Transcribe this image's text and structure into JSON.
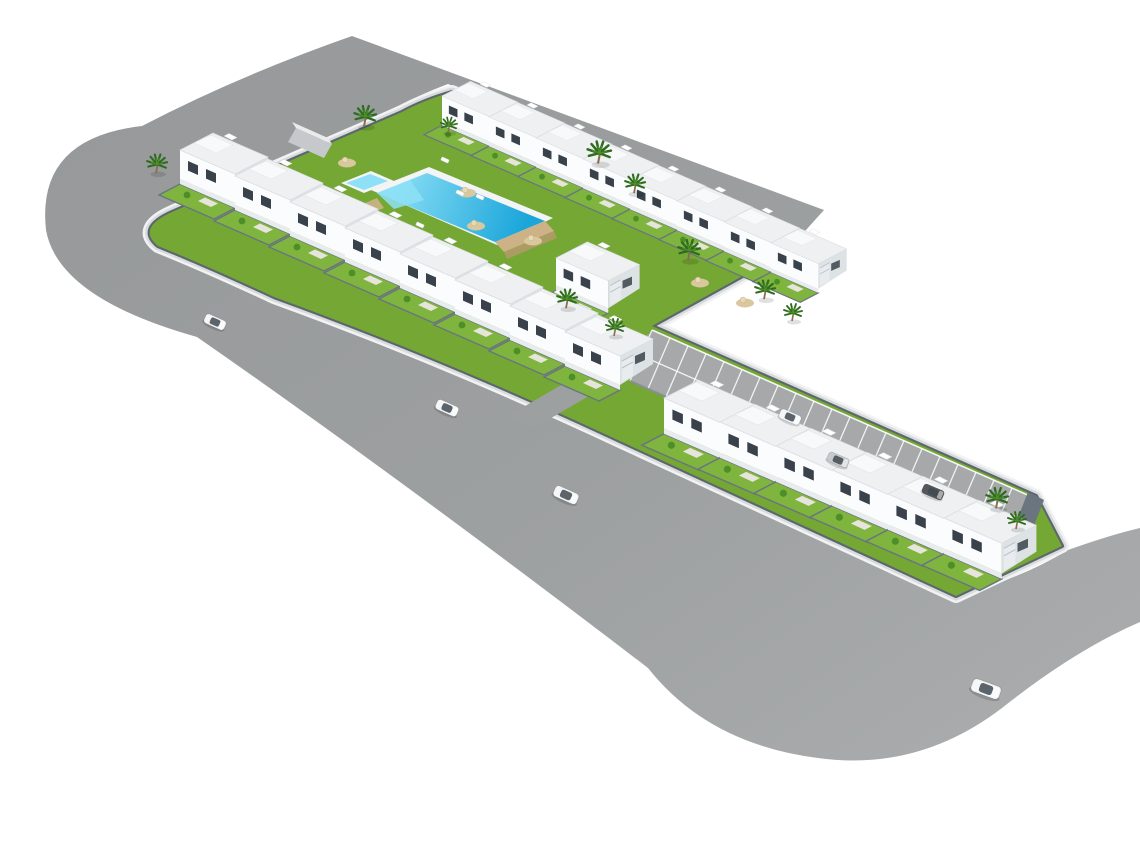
{
  "scene": {
    "description": "Aerial 3D architectural rendering of an L-shaped residential development: rows of white two-storey terraced houses with external staircases and private lawned gardens, a communal garden with swimming pool and kids pool, a striped private parking strip, all enclosed by a perimeter wall and wrapped by a gray ring road with rounded corners on a plain white background",
    "background": "#ffffff"
  },
  "colors": {
    "background": "#ffffff",
    "road": "#9da0a1",
    "road_dark": "#96989a",
    "road_light": "#abadae",
    "curb": "#f1f2f3",
    "sidewalk": "#d8dadc",
    "wall": "#5c666f",
    "lawn": "#74a733",
    "lawn_light": "#7fb53e",
    "roof": "#eef0f1",
    "roof_top": "#f8f9fa",
    "face": "#fbfcfd",
    "face_side": "#dde2e5",
    "window": "#39424b",
    "terrace": "#e9ecee",
    "garden_wall": "#6a7580",
    "pool_rim": "#f2f4f5",
    "pool_water": "#1ba6da",
    "pool_water_light": "#8ee0f6",
    "deck": "#ccb286",
    "dirt": "#d9c79e",
    "palm": "#2f6b1f",
    "palm_light": "#4c8e27",
    "trunk": "#8a6d4a",
    "car_white": "#f5f6f7",
    "car_silver": "#c7cacd",
    "car_dark": "#54575b",
    "car_glass": "#414a52",
    "parking": "#a6a8a9",
    "stripe": "#ffffff",
    "shed": "#c5c9cb",
    "shed_top": "#e9ebec",
    "patio": "#e7e4db"
  },
  "counts": {
    "houses_total": 23,
    "house_rows": 4,
    "parking_spaces": 21,
    "cars_total": 7,
    "palm_trees": 12,
    "pools": 2
  },
  "site": {
    "house_rows": [
      {
        "name": "upper-row",
        "count": 8,
        "origin": [
          442,
          96
        ],
        "step": [
          47,
          21
        ],
        "scale": 0.86
      },
      {
        "name": "detached-unit",
        "count": 1,
        "origin": [
          556,
          258
        ],
        "step": [
          0,
          0
        ],
        "scale": 0.95
      },
      {
        "name": "main-row-west",
        "count": 8,
        "origin": [
          180,
          150
        ],
        "step": [
          55,
          26
        ],
        "scale": 1.0
      },
      {
        "name": "main-row-arm",
        "count": 6,
        "origin": [
          664,
          398
        ],
        "step": [
          56,
          24
        ],
        "scale": 1.05
      }
    ]
  },
  "parking": {
    "spaces": 21,
    "ne_edge_start": [
      652,
      330
    ],
    "ne_edge_end": [
      1030,
      496
    ],
    "depth_vector": [
      -22,
      51
    ]
  },
  "cars": [
    {
      "x": 215,
      "y": 322,
      "angle": 24,
      "scale": 1.0,
      "color": "car_white",
      "location": "west-road"
    },
    {
      "x": 447,
      "y": 408,
      "angle": 24,
      "scale": 1.05,
      "color": "car_white",
      "location": "main-road"
    },
    {
      "x": 566,
      "y": 495,
      "angle": 24,
      "scale": 1.15,
      "color": "car_white",
      "location": "main-road"
    },
    {
      "x": 986,
      "y": 689,
      "angle": 20,
      "scale": 1.35,
      "color": "car_white",
      "location": "south-east-road"
    },
    {
      "x": 790,
      "y": 417,
      "angle": 23,
      "scale": 1.0,
      "color": "car_white",
      "location": "parking-strip"
    },
    {
      "x": 838,
      "y": 460,
      "angle": 23,
      "scale": 1.0,
      "color": "car_silver",
      "location": "parking-strip"
    },
    {
      "x": 933,
      "y": 492,
      "angle": 23,
      "scale": 1.0,
      "color": "car_dark",
      "location": "parking-strip"
    }
  ],
  "palms": [
    [
      156,
      171,
      1.1
    ],
    [
      364,
      124,
      1.2
    ],
    [
      448,
      131,
      0.9
    ],
    [
      598,
      161,
      1.3
    ],
    [
      634,
      191,
      1.1
    ],
    [
      688,
      258,
      1.2
    ],
    [
      764,
      297,
      1.1
    ],
    [
      792,
      319,
      1.0
    ],
    [
      566,
      306,
      1.1
    ],
    [
      614,
      334,
      1.0
    ],
    [
      996,
      506,
      1.2
    ],
    [
      1016,
      527,
      1.0
    ]
  ],
  "dirt_patches": [
    [
      310,
      184
    ],
    [
      347,
      163
    ],
    [
      467,
      193
    ],
    [
      476,
      226
    ],
    [
      533,
      241
    ],
    [
      660,
      226
    ],
    [
      700,
      283
    ],
    [
      745,
      303
    ]
  ],
  "loungers": [
    [
      445,
      160
    ],
    [
      460,
      193
    ],
    [
      480,
      197
    ],
    [
      302,
      184
    ],
    [
      420,
      225
    ]
  ]
}
